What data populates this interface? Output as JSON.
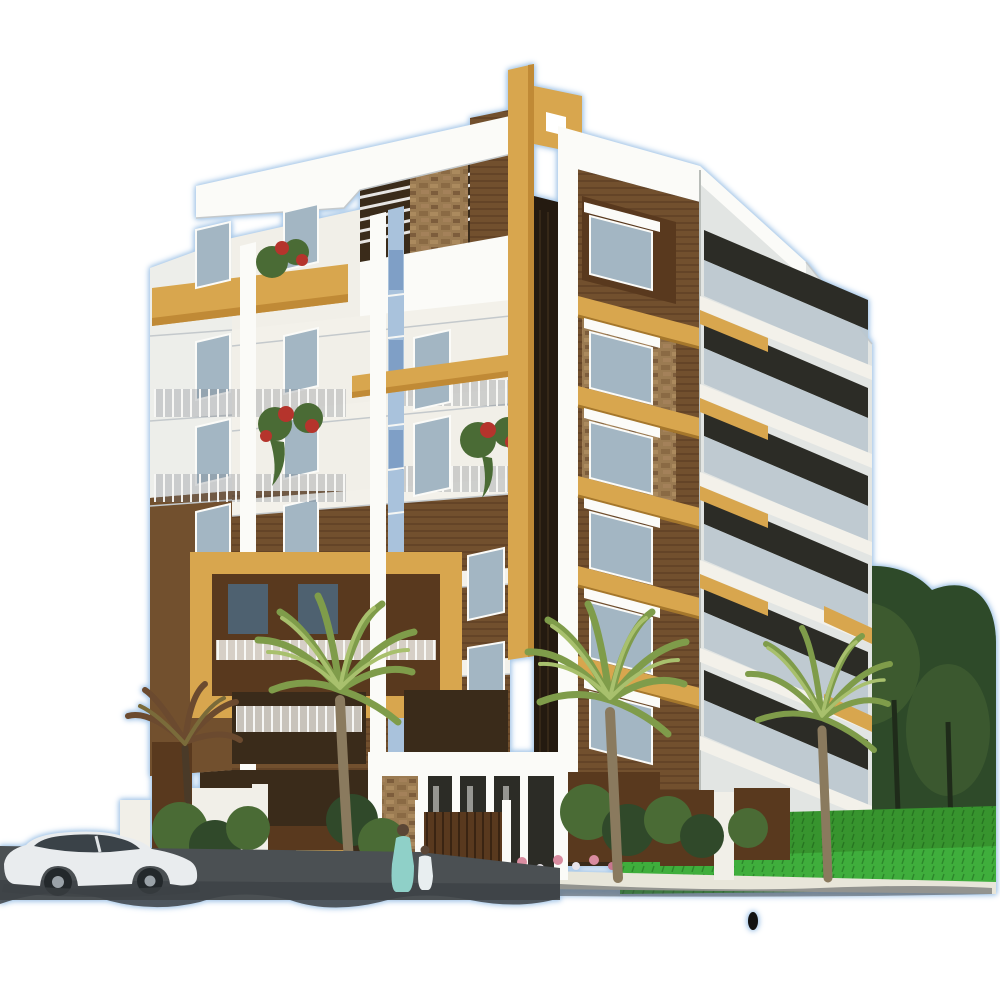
{
  "meta": {
    "title": "3D architectural rendering of a five-storey residential apartment building with palm trees, landscaped compound, white sedan car and entrance gate, cut out on a plain white background",
    "image_type": "real-estate exterior render (no text, no UI controls)",
    "background": "plain white with a light blue halo around the cut-out silhouette"
  },
  "palette": {
    "bg": "#ffffff",
    "halo-blue": "#a9c9e9",
    "wall-white": "#f1efe8",
    "wall-shade": "#e2e5e3",
    "fascia-white": "#fbfbf8",
    "slab-white": "#f3f1ea",
    "side-white": "#edeeea",
    "gold": "#d8a64e",
    "gold-dark": "#c08a36",
    "gold-light": "#eac573",
    "brown-wall": "#72502e",
    "brown-dark": "#59391e",
    "brown-deep": "#3a2b1a",
    "stone": "#9b7b52",
    "glass-blue": "#a9c2dc",
    "glass-pane": "#7f9fc6",
    "window-glass": "#a3b6c3",
    "window-dark": "#4e6170",
    "rail-glass": "#bcc8cf",
    "recess-dark": "#2c2c26",
    "green-lawn": "#3fae3c",
    "green-hedge": "#37942e",
    "green-tree": "#2e4a29",
    "green-tree-light": "#476534",
    "palm-green": "#7f9c4a",
    "palm-green-light": "#a8c06d",
    "palm-trunk": "#8a7a5e",
    "shrub-green": "#4a6b35",
    "shrub-dark": "#30492a",
    "flower-red": "#b5342c",
    "flower-pink": "#d98ca0",
    "road-gray": "#4b5053",
    "shadow-dark": "#3d4246",
    "car-white": "#e9ecee",
    "car-window": "#3a4248",
    "sari-teal": "#8fd0c8"
  },
  "scene": {
    "building": {
      "storeys": 5,
      "style": "modern Indian apartment elevation",
      "left_tower": "white upper floors, brown plank-textured lower floors, big golden frame feature, balconies with slim railings, red flower boxes, sloped white roof fascia with pergola slats and stone-clad column",
      "center": "golden flag-shaped pylon with square cut-out, dark recessed vertical strip, blue glass curtain strip",
      "right_tower": "brown facade with stone window surrounds, golden slab band on every floor, receding white balcony wing with glass balustrades",
      "ground_floor": "white entrance portico with brown gate, stone side panel, compound wall in white and brown"
    },
    "vegetation": {
      "palms": "three tall yellow-green palm trees in front of the facade plus one small dark palm at far left",
      "trees": "dense dark green trees filling the right side",
      "hedge_and_lawn": "bright green trimmed hedge and lawn strip along the right foreground",
      "shrubs": "bushes and a pink flower bed along the compound wall"
    },
    "vehicle": "white sedan car parked on the dark grey road at bottom left",
    "people": "woman in a teal sari walking with a small child in white near the gate",
    "artifacts": "soft dark shadow scallops along the bottom edge and a small black oval mark below the hedge"
  }
}
